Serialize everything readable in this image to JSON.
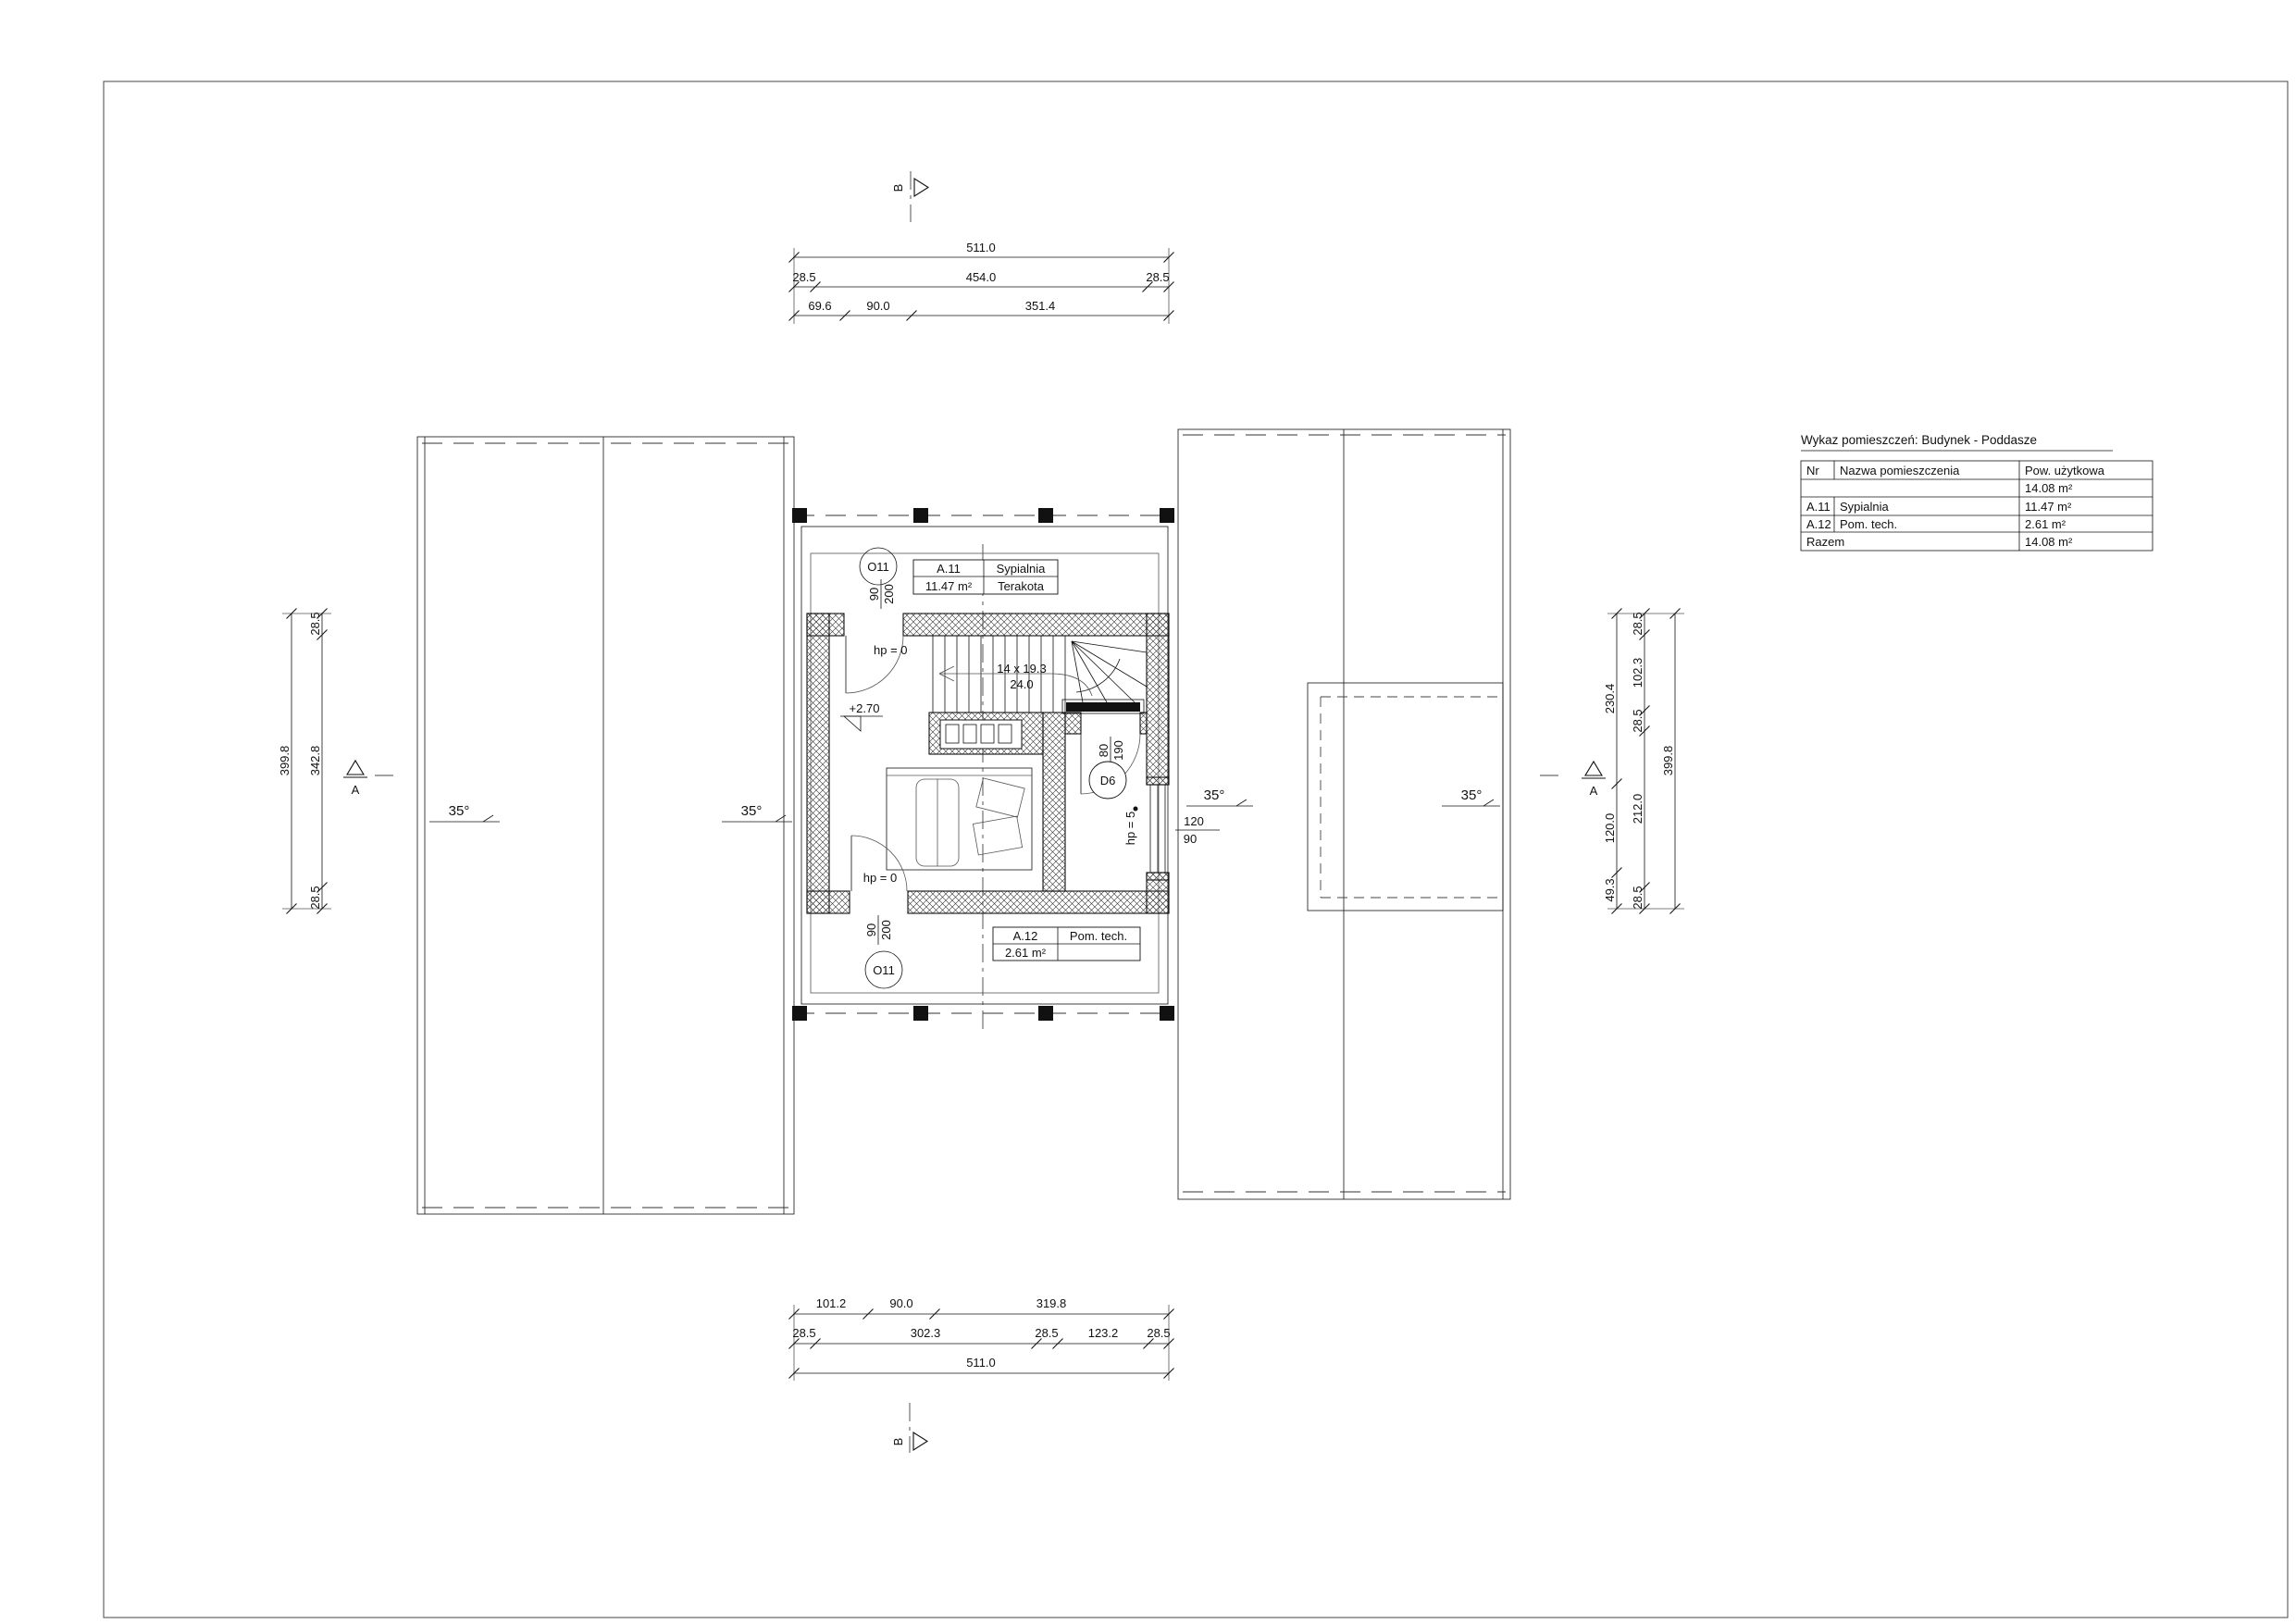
{
  "colors": {
    "ink": "#111111",
    "paper": "#ffffff",
    "muted": "#555555"
  },
  "section_markers": {
    "top": "B",
    "bottom": "B",
    "left": "A",
    "right": "A"
  },
  "dimensions": {
    "top": {
      "row1": [
        "511.0"
      ],
      "row2": [
        "28.5",
        "454.0",
        "28.5"
      ],
      "row3": [
        "69.6",
        "90.0",
        "351.4"
      ]
    },
    "bottom": {
      "row1": [
        "101.2",
        "90.0",
        "319.8"
      ],
      "row2": [
        "28.5",
        "302.3",
        "28.5",
        "123.2",
        "28.5"
      ],
      "row3": [
        "511.0"
      ]
    },
    "left": {
      "outer": "399.8",
      "inner": [
        "28.5",
        "342.8",
        "28.5"
      ]
    },
    "right": {
      "inner": [
        "230.4",
        "120.0",
        "49.3"
      ],
      "middle": [
        "28.5",
        "102.3",
        "28.5",
        "212.0",
        "28.5"
      ],
      "outer": "399.8"
    }
  },
  "roof": {
    "slope_labels": [
      "35°",
      "35°",
      "35°",
      "35°"
    ]
  },
  "plan": {
    "level_label": "+2.70",
    "stairs": {
      "label_line1": "14 x 19.3",
      "label_line2": "24.0"
    },
    "rooms": [
      {
        "nr": "A.11",
        "name": "Sypialnia",
        "area": "11.47 m²",
        "finish": "Terakota"
      },
      {
        "nr": "A.12",
        "name": "Pom. tech.",
        "area": "2.61 m²"
      }
    ],
    "openings": {
      "window_top": {
        "tag": "O11",
        "width": "90",
        "height": "200",
        "sill": "hp = 0"
      },
      "window_bottom": {
        "tag": "O11",
        "width": "90",
        "height": "200",
        "sill": "hp = 0"
      },
      "window_right": {
        "width": "120",
        "height": "90",
        "sill": "hp = 5"
      },
      "door": {
        "tag": "D6",
        "width": "80",
        "height": "190"
      }
    }
  },
  "legend_table": {
    "title": "Wykaz pomieszczeń: Budynek - Poddasze",
    "headers": [
      "Nr",
      "Nazwa pomieszczenia",
      "Pow. użytkowa"
    ],
    "rows": [
      {
        "nr": "",
        "name": "",
        "area": "14.08 m²"
      },
      {
        "nr": "A.11",
        "name": "Sypialnia",
        "area": "11.47 m²"
      },
      {
        "nr": "A.12",
        "name": "Pom. tech.",
        "area": "2.61 m²"
      },
      {
        "nr": "Razem",
        "name": "",
        "area": "14.08 m²"
      }
    ]
  }
}
